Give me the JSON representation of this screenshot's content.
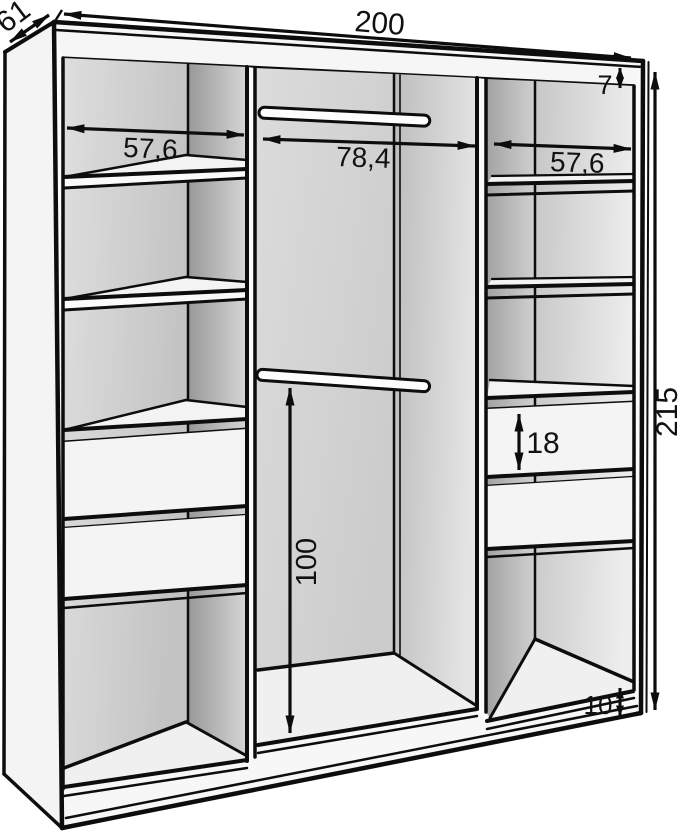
{
  "diagram": {
    "type": "furniture-dimension-drawing",
    "subject": "three-section wardrobe interior with shelves, drawers and hanging rods",
    "dimensions": {
      "total_width": "200",
      "side_depth": "61",
      "total_height": "215",
      "top_panel_thickness": "7",
      "left_section_width": "57,6",
      "middle_section_width": "78,4",
      "right_section_width": "57,6",
      "drawer_front_height": "18",
      "hanging_space_height": "100",
      "base_height": "10"
    },
    "colors": {
      "outline": "#0d0d0d",
      "panel_light": "#f6f6f6",
      "back_panel": "#d2d2d2",
      "partition_shadow": "#a0a0a0",
      "background": "#ffffff"
    }
  }
}
